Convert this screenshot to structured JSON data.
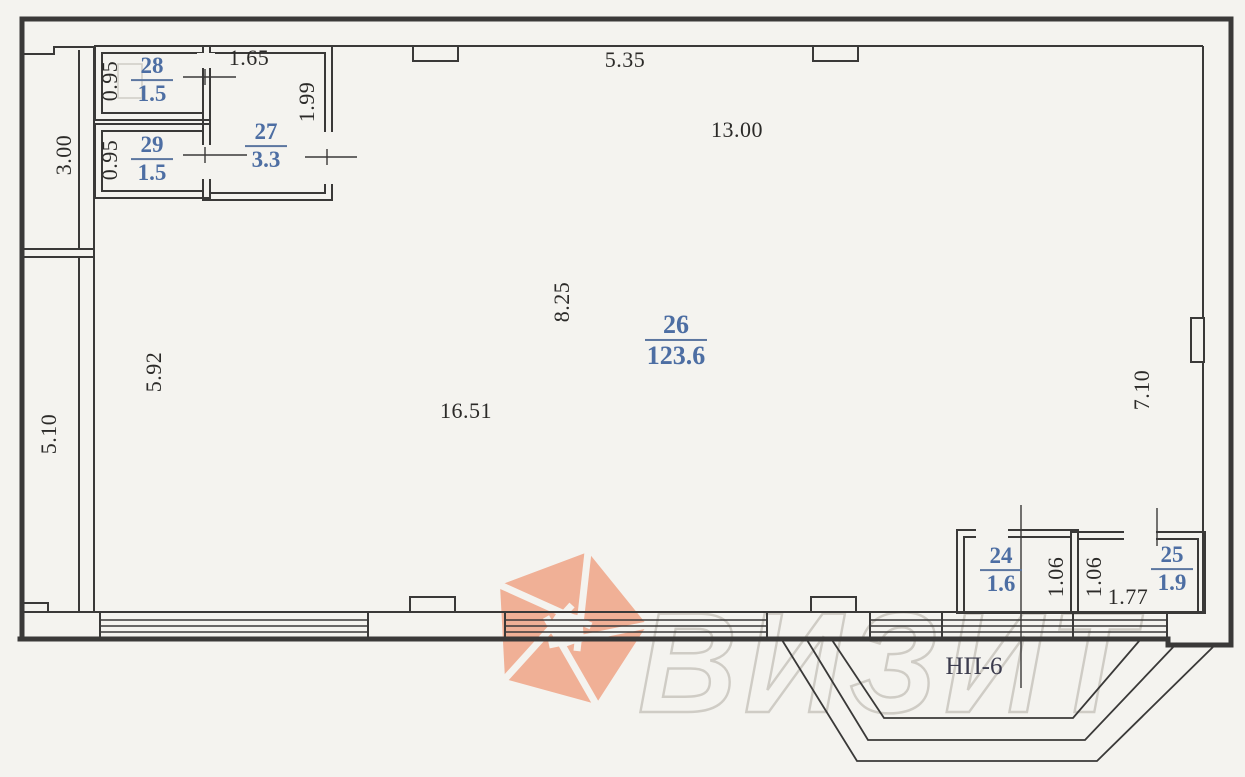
{
  "document": {
    "type": "scanned floor plan"
  },
  "rooms": {
    "r24": {
      "number": "24",
      "area": "1.6"
    },
    "r25": {
      "number": "25",
      "area": "1.9"
    },
    "r26": {
      "number": "26",
      "area": "123.6"
    },
    "r27": {
      "number": "27",
      "area": "3.3"
    },
    "r28": {
      "number": "28",
      "area": "1.5"
    },
    "r29": {
      "number": "29",
      "area": "1.5"
    }
  },
  "dimensions": {
    "v_3_00": "3.00",
    "v_0_95_a": "0.95",
    "v_0_95_b": "0.95",
    "h_1_65": "1.65",
    "v_1_99": "1.99",
    "h_5_35": "5.35",
    "h_13_00": "13.00",
    "v_8_25": "8.25",
    "h_16_51": "16.51",
    "v_5_92": "5.92",
    "v_5_10": "5.10",
    "v_7_10": "7.10",
    "v_1_06_a": "1.06",
    "v_1_06_b": "1.06",
    "h_1_77": "1.77"
  },
  "labels": {
    "premise": "НП-6",
    "watermark": "ВИЗИТ"
  },
  "colors": {
    "ink": "#3a3938",
    "room_number_blue": "#4d6ea3",
    "logo_salmon": "#f0b096",
    "watermark_gray": "#cfccc5",
    "paper": "#f4f3ef"
  }
}
